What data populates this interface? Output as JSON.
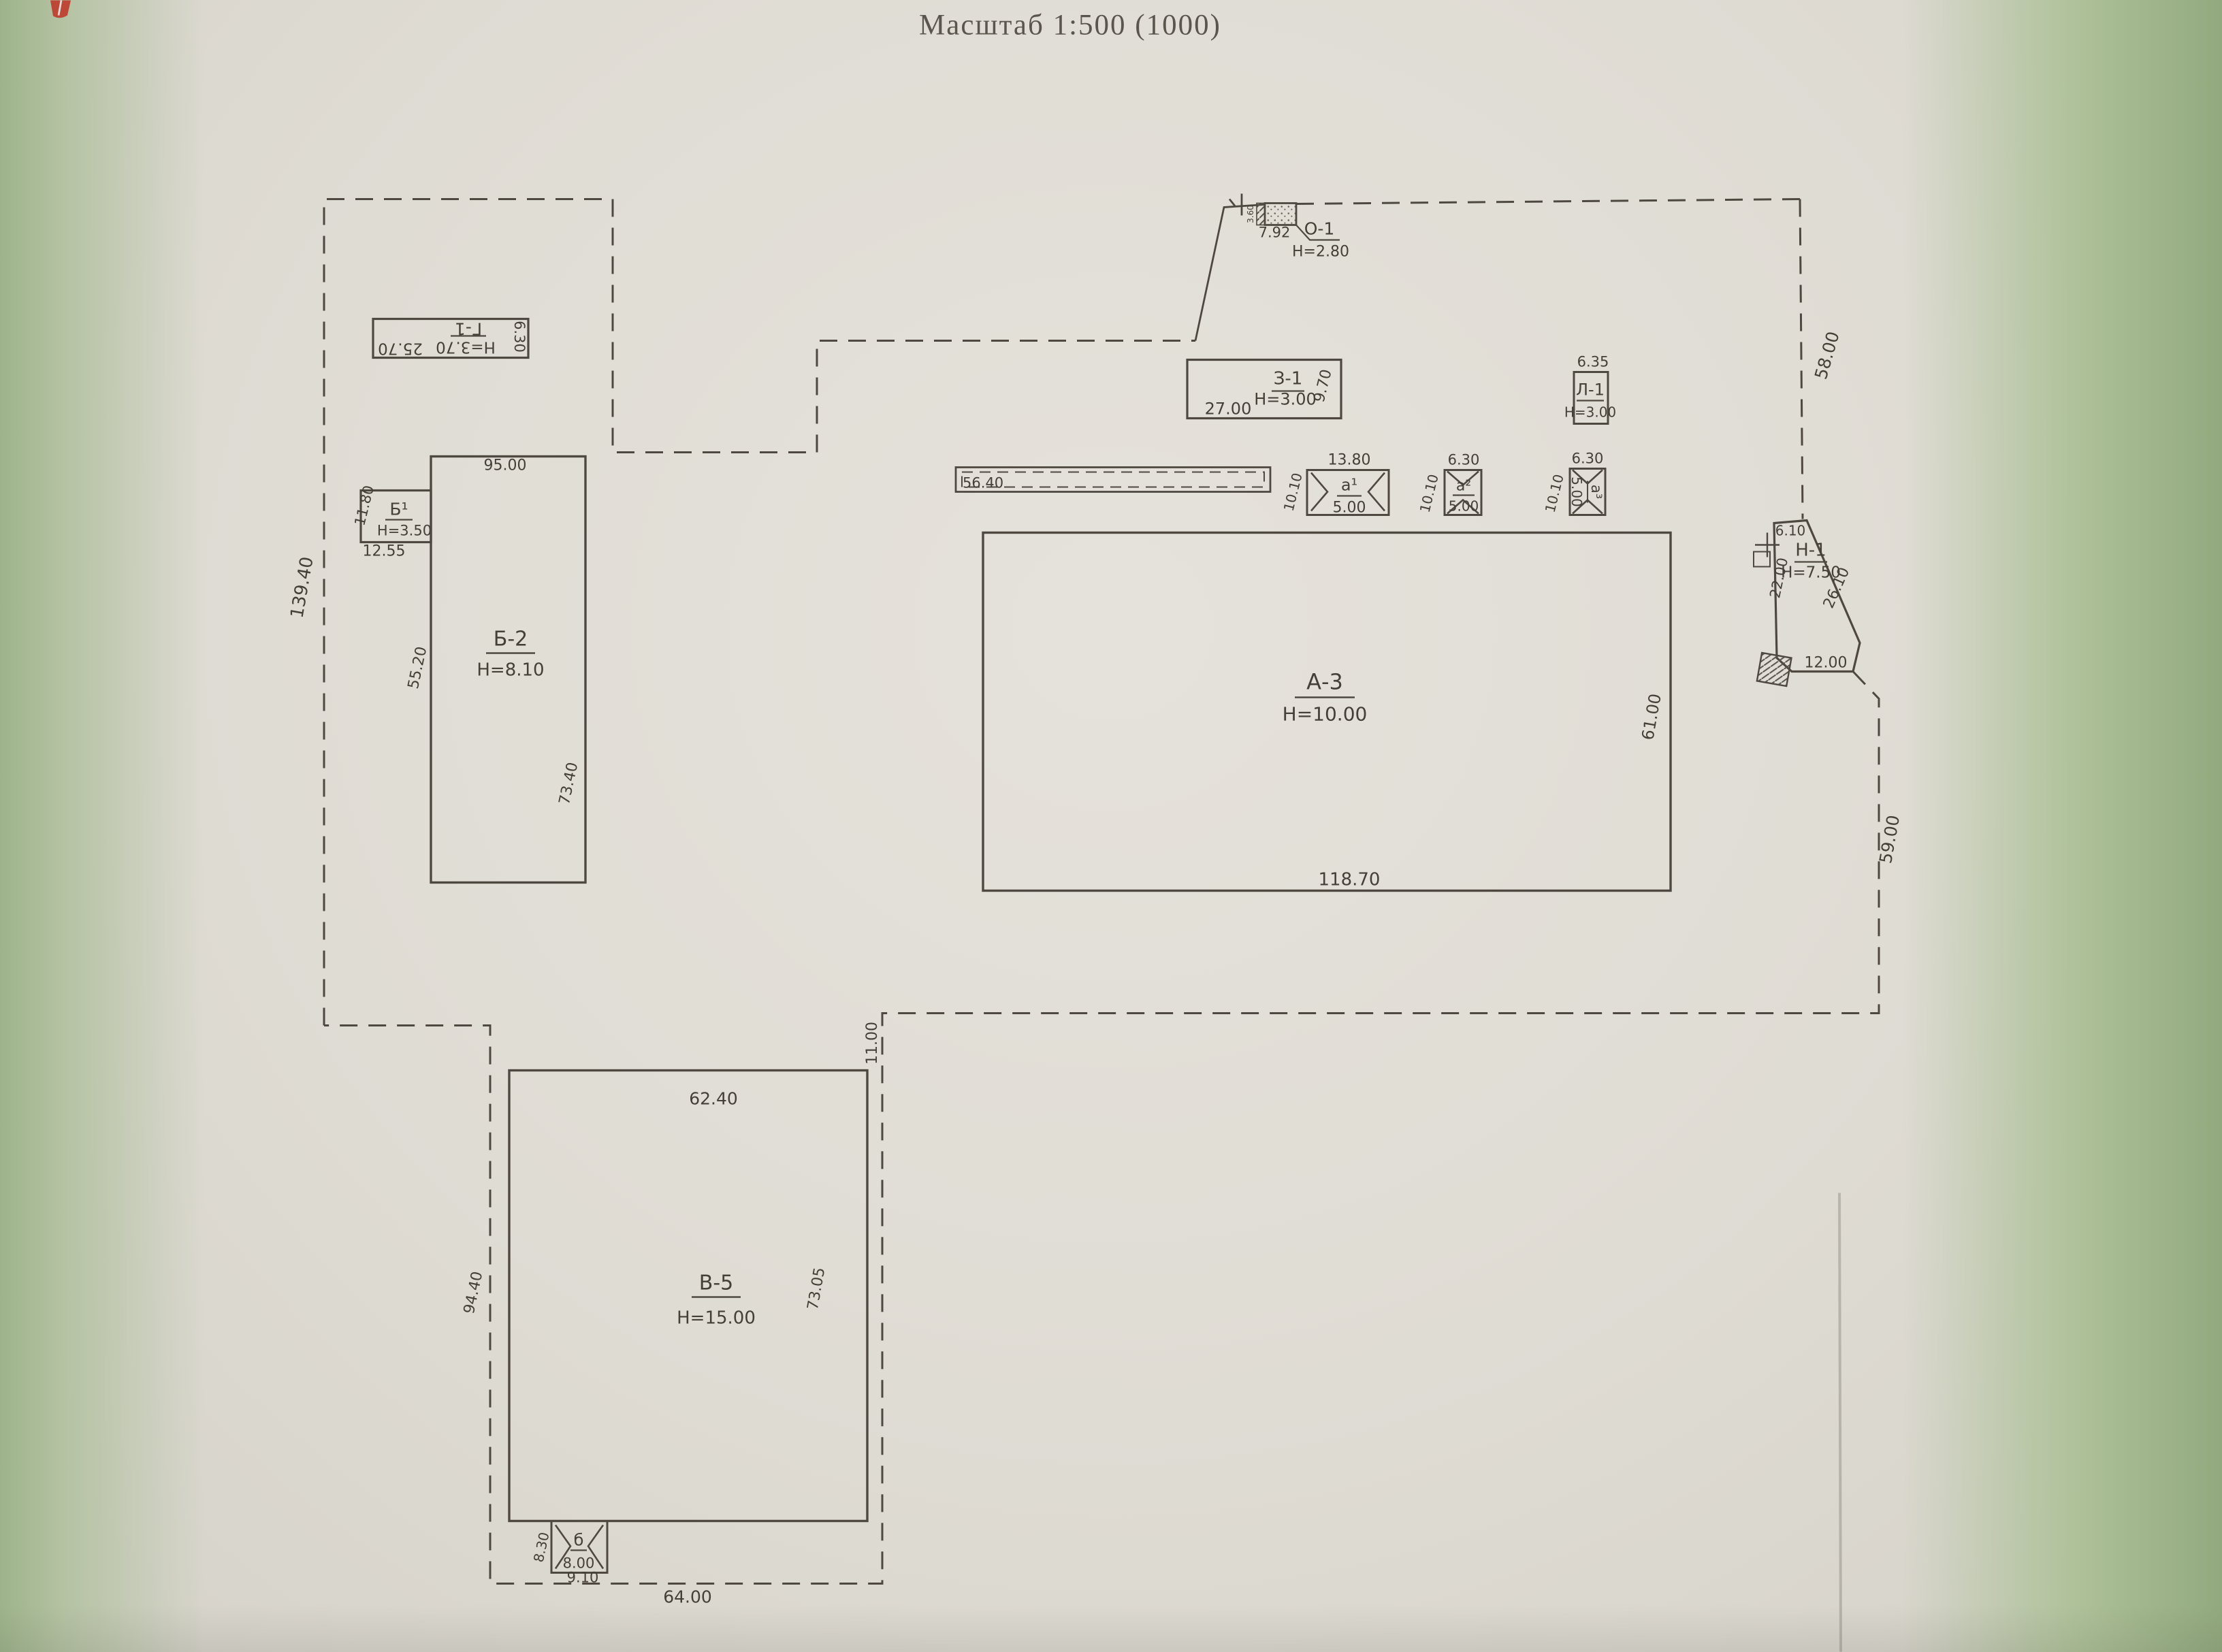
{
  "title": "Масштаб 1:500 (1000)",
  "site": {
    "left": "139.40",
    "top_right": "58.00",
    "right": "59.00",
    "offset": "11.00",
    "bottom": "64.00"
  },
  "buildings": {
    "g1": {
      "label": "Г-1",
      "h": "Н=3.70",
      "len": "25.70",
      "wid": "6.30"
    },
    "b1": {
      "label": "Б¹",
      "h": "Н=3.50",
      "side": "11.80",
      "bottom": "12.55"
    },
    "b2": {
      "label": "Б-2",
      "h": "Н=8.10",
      "top": "95.00",
      "left": "55.20",
      "right": "73.40"
    },
    "a3": {
      "label": "А-3",
      "h": "Н=10.00",
      "bottom": "118.70",
      "right": "61.00"
    },
    "v5": {
      "label": "В-5",
      "h": "Н=15.00",
      "top": "62.40",
      "left": "94.40",
      "right": "73.05"
    },
    "z1": {
      "label": "З-1",
      "h": "Н=3.00",
      "bottom": "27.00",
      "right": "9.70"
    },
    "l1": {
      "label": "Л-1",
      "h": "Н=3.00",
      "top": "6.35"
    },
    "o1": {
      "label": "О-1",
      "h": "Н=2.80",
      "len": "7.92",
      "side": "3.60"
    },
    "n1": {
      "label": "Н-1",
      "h": "Н=7.50",
      "top": "6.10",
      "left": "22.00",
      "diag": "26.10",
      "bottom": "12.00"
    },
    "gallery": {
      "len": "56.40"
    },
    "p1": {
      "label": "а¹",
      "top": "13.80",
      "val": "5.00",
      "side": "10.10"
    },
    "p2": {
      "label": "а²",
      "top": "6.30",
      "val": "5.00",
      "side": "10.10"
    },
    "p3": {
      "label": "а³",
      "top": "6.30",
      "val": "5.00",
      "side": "10.10"
    },
    "b_small": {
      "label": "б",
      "val": "8.00",
      "side": "8.30",
      "bottom": "9.10"
    }
  }
}
